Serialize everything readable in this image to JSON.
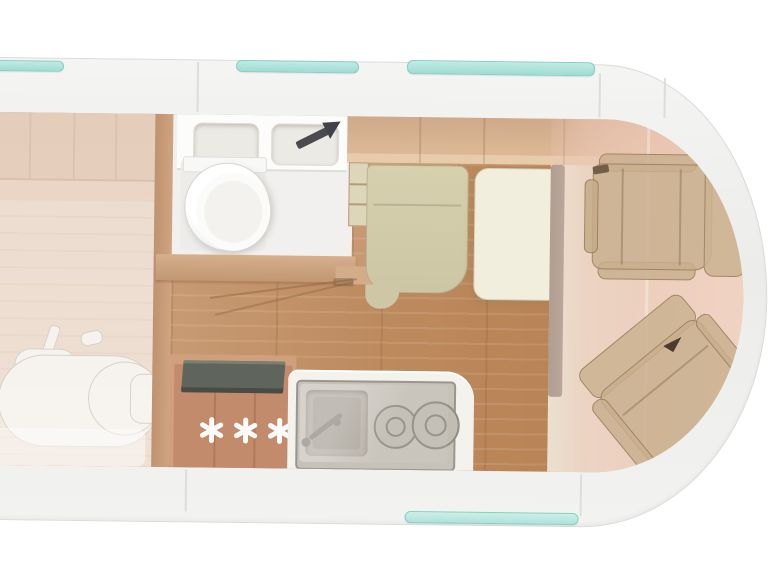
{
  "scene": {
    "name": "motorhome-floorplan-top-view",
    "vehicle_type": "campervan",
    "view": "overhead-cutaway"
  },
  "areas": {
    "rear_bed_garage": {
      "label": "rear-bed-over-garage",
      "stored_item": "scooter-ghost"
    },
    "bathroom": {
      "fixtures": [
        "washbasin-double",
        "toilet"
      ],
      "door_indicator": "entrance-arrow"
    },
    "kitchen": {
      "appliances": [
        "refrigerator",
        "sink",
        "two-burner-hob"
      ],
      "freezer_symbols": [
        "✳",
        "✳",
        "✳"
      ]
    },
    "dinette": {
      "furniture": [
        "bench-seat",
        "table"
      ]
    },
    "cab": {
      "seats": [
        "front-seat",
        "swivel-seat"
      ],
      "tint": "pink-overlay"
    }
  },
  "windows": {
    "count": 4,
    "positions": [
      "top-rear",
      "top-center",
      "top-front",
      "bottom-front"
    ]
  },
  "colors": {
    "background": "#ffffff",
    "body_shell": "#f0efee",
    "window_teal": "#a6e1d9",
    "wood_wall": "#cfa98c",
    "wood_floor": "#c18e66",
    "bath_floor": "#f1f0ee",
    "bench_cushion": "#d2cca9",
    "table_cream": "#f2eedd",
    "cab_tint": "#ecc8b4",
    "seat_tan": "#c7ae8f",
    "fridge_top": "#5f655c",
    "steel_unit": "#c7c2b9",
    "arrow_dark": "#4a4a4f"
  }
}
